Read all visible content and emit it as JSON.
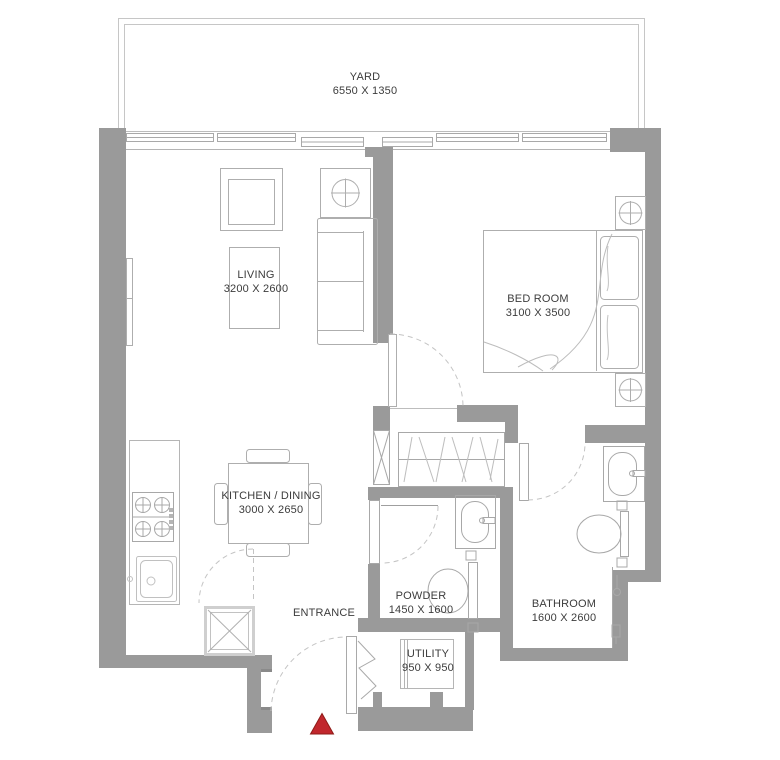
{
  "plan_title": "apartment-floor-plan",
  "rooms": {
    "yard": {
      "label": "YARD",
      "dims": "6550 X 1350"
    },
    "living": {
      "label": "LIVING",
      "dims": "3200 X 2600"
    },
    "bedroom": {
      "label": "BED ROOM",
      "dims": "3100 X 3500"
    },
    "kitchen": {
      "label": "KITCHEN / DINING",
      "dims": "3000 X 2650"
    },
    "powder": {
      "label": "POWDER",
      "dims": "1450 X 1600"
    },
    "bathroom": {
      "label": "BATHROOM",
      "dims": "1600 X 2600"
    },
    "utility": {
      "label": "UTILITY",
      "dims": "950 X 950"
    },
    "entrance": {
      "label": "ENTRANCE",
      "dims": ""
    }
  },
  "icons": {
    "entrance_marker": "red-triangle-direction-marker",
    "shaft": "x-cross-shaft-icon",
    "lamps": "circle-cross-lamp-icon",
    "stove": "four-burner-hob-icon",
    "washer": "washing-machine-icon"
  },
  "colors": {
    "wall": "#9a9a9a",
    "furniture_line": "#aeaeae",
    "light_line": "#c6c6c6",
    "text": "#3c3c3c",
    "entrance_marker": "#c1272d"
  }
}
